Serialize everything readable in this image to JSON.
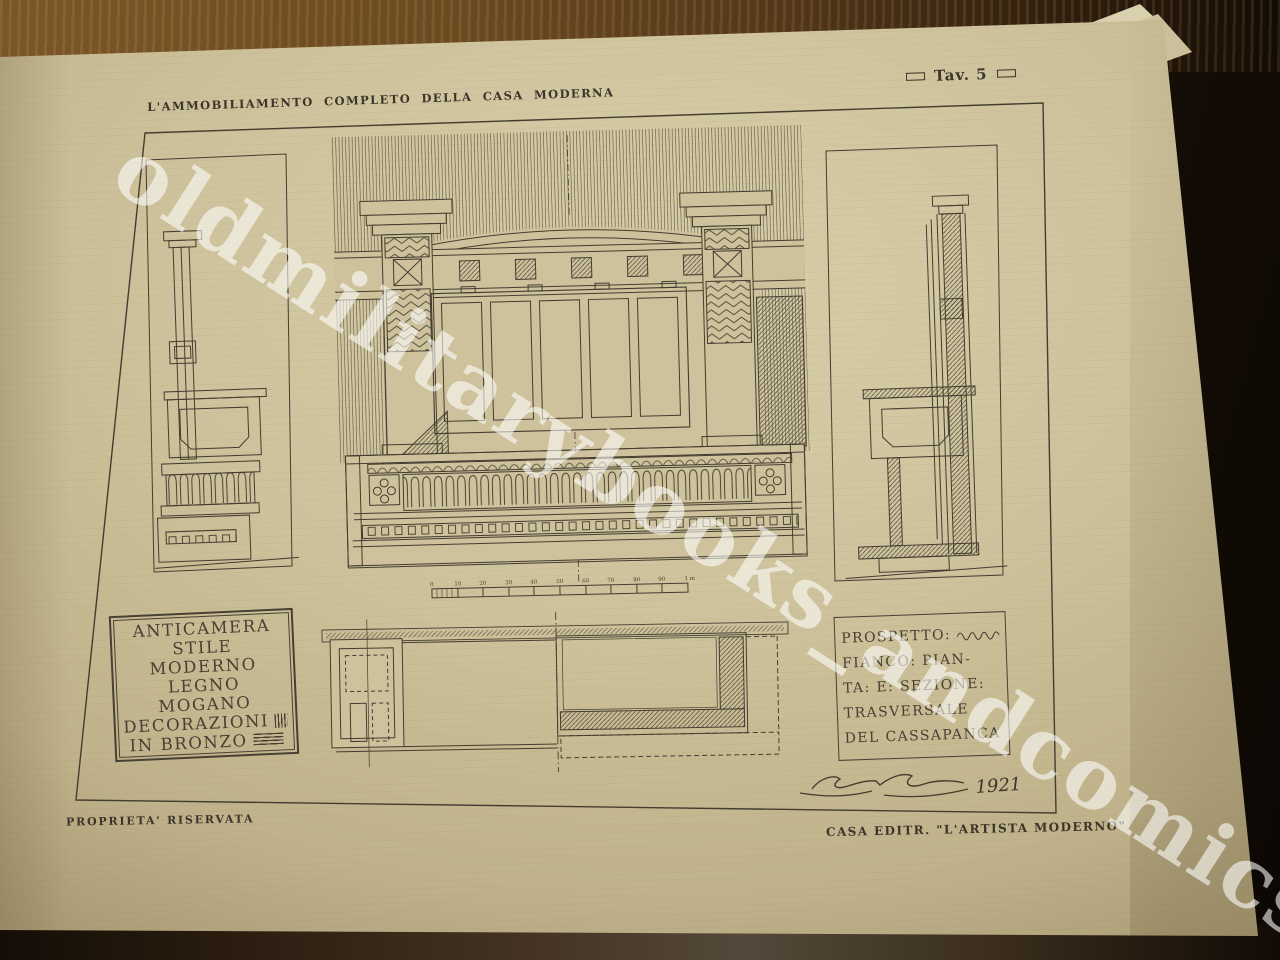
{
  "photo": {
    "watermark_text": "oldmilitarybooks_andcomics"
  },
  "plate": {
    "series_title": "L'AMMOBILIAMENTO COMPLETO DELLA CASA MODERNA",
    "plate_label": "Tav. 5",
    "footer_left": "PROPRIETA' RISERVATA",
    "footer_right": "CASA EDITR. \"L'ARTISTA MODERNO\"",
    "signature_year": "1921",
    "captions": {
      "left_box_lines": [
        "ANTICAMERA",
        "STILE MODERNO",
        "LEGNO MOGANO",
        "DECORAZIONI",
        "IN BRONZO"
      ],
      "right_box_lines": [
        "PROSPETTO:",
        "FIANCO: PIAN-",
        "TA: E: SEZIONE:",
        "TRASVERSALE",
        "DEL CASSAPANCA"
      ]
    },
    "scale_bar_labels": [
      "0",
      "10",
      "20",
      "30",
      "40",
      "50",
      "60",
      "70",
      "80",
      "90",
      "1 m"
    ],
    "colors": {
      "ink": "#433d30",
      "paper": "#cdc29b",
      "paper_light": "#d8cea8",
      "backdrop": "#120b05",
      "table_wood": "#6a4a21",
      "watermark": "#ffffff"
    }
  }
}
